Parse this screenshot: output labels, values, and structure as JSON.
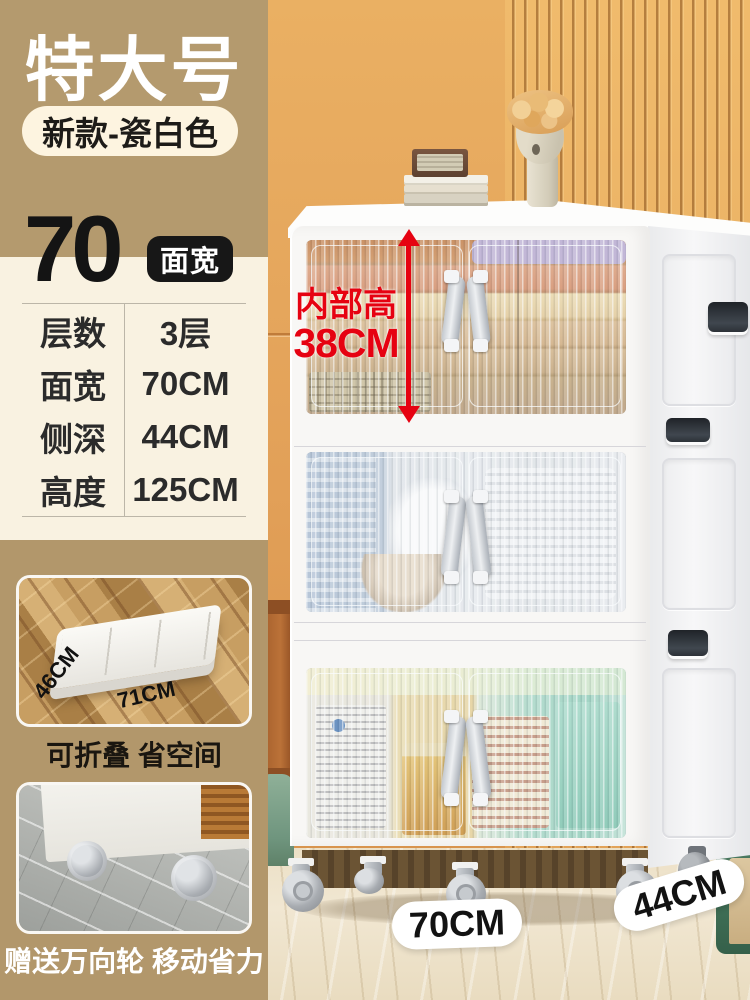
{
  "header": {
    "size_badge": "特大号",
    "variant_badge": "新款-瓷白色"
  },
  "spec_panel": {
    "width_value": "70",
    "width_unit": "面宽",
    "rows": [
      {
        "label": "层数",
        "value": "3层"
      },
      {
        "label": "面宽",
        "value": "70CM"
      },
      {
        "label": "侧深",
        "value": "44CM"
      },
      {
        "label": "高度",
        "value": "125CM"
      }
    ]
  },
  "feature_cards": {
    "fold": {
      "caption": "可折叠 省空间",
      "depth_label": "46CM",
      "width_label": "71CM"
    },
    "wheels": {
      "caption": "赠送万向轮 移动省力"
    }
  },
  "product_annotations": {
    "inner_height_title": "内部高",
    "inner_height_value": "38CM",
    "front_width": "70CM",
    "side_depth": "44CM"
  },
  "colors": {
    "accent_red": "#e60211",
    "badge_tan": "#b49a6e",
    "panel_cream": "#f9f2e1",
    "pill_cream": "#fdf4e0",
    "section_tan": "#b2976b",
    "wall_orange": "#e7a85e",
    "chip_black": "#171717"
  }
}
